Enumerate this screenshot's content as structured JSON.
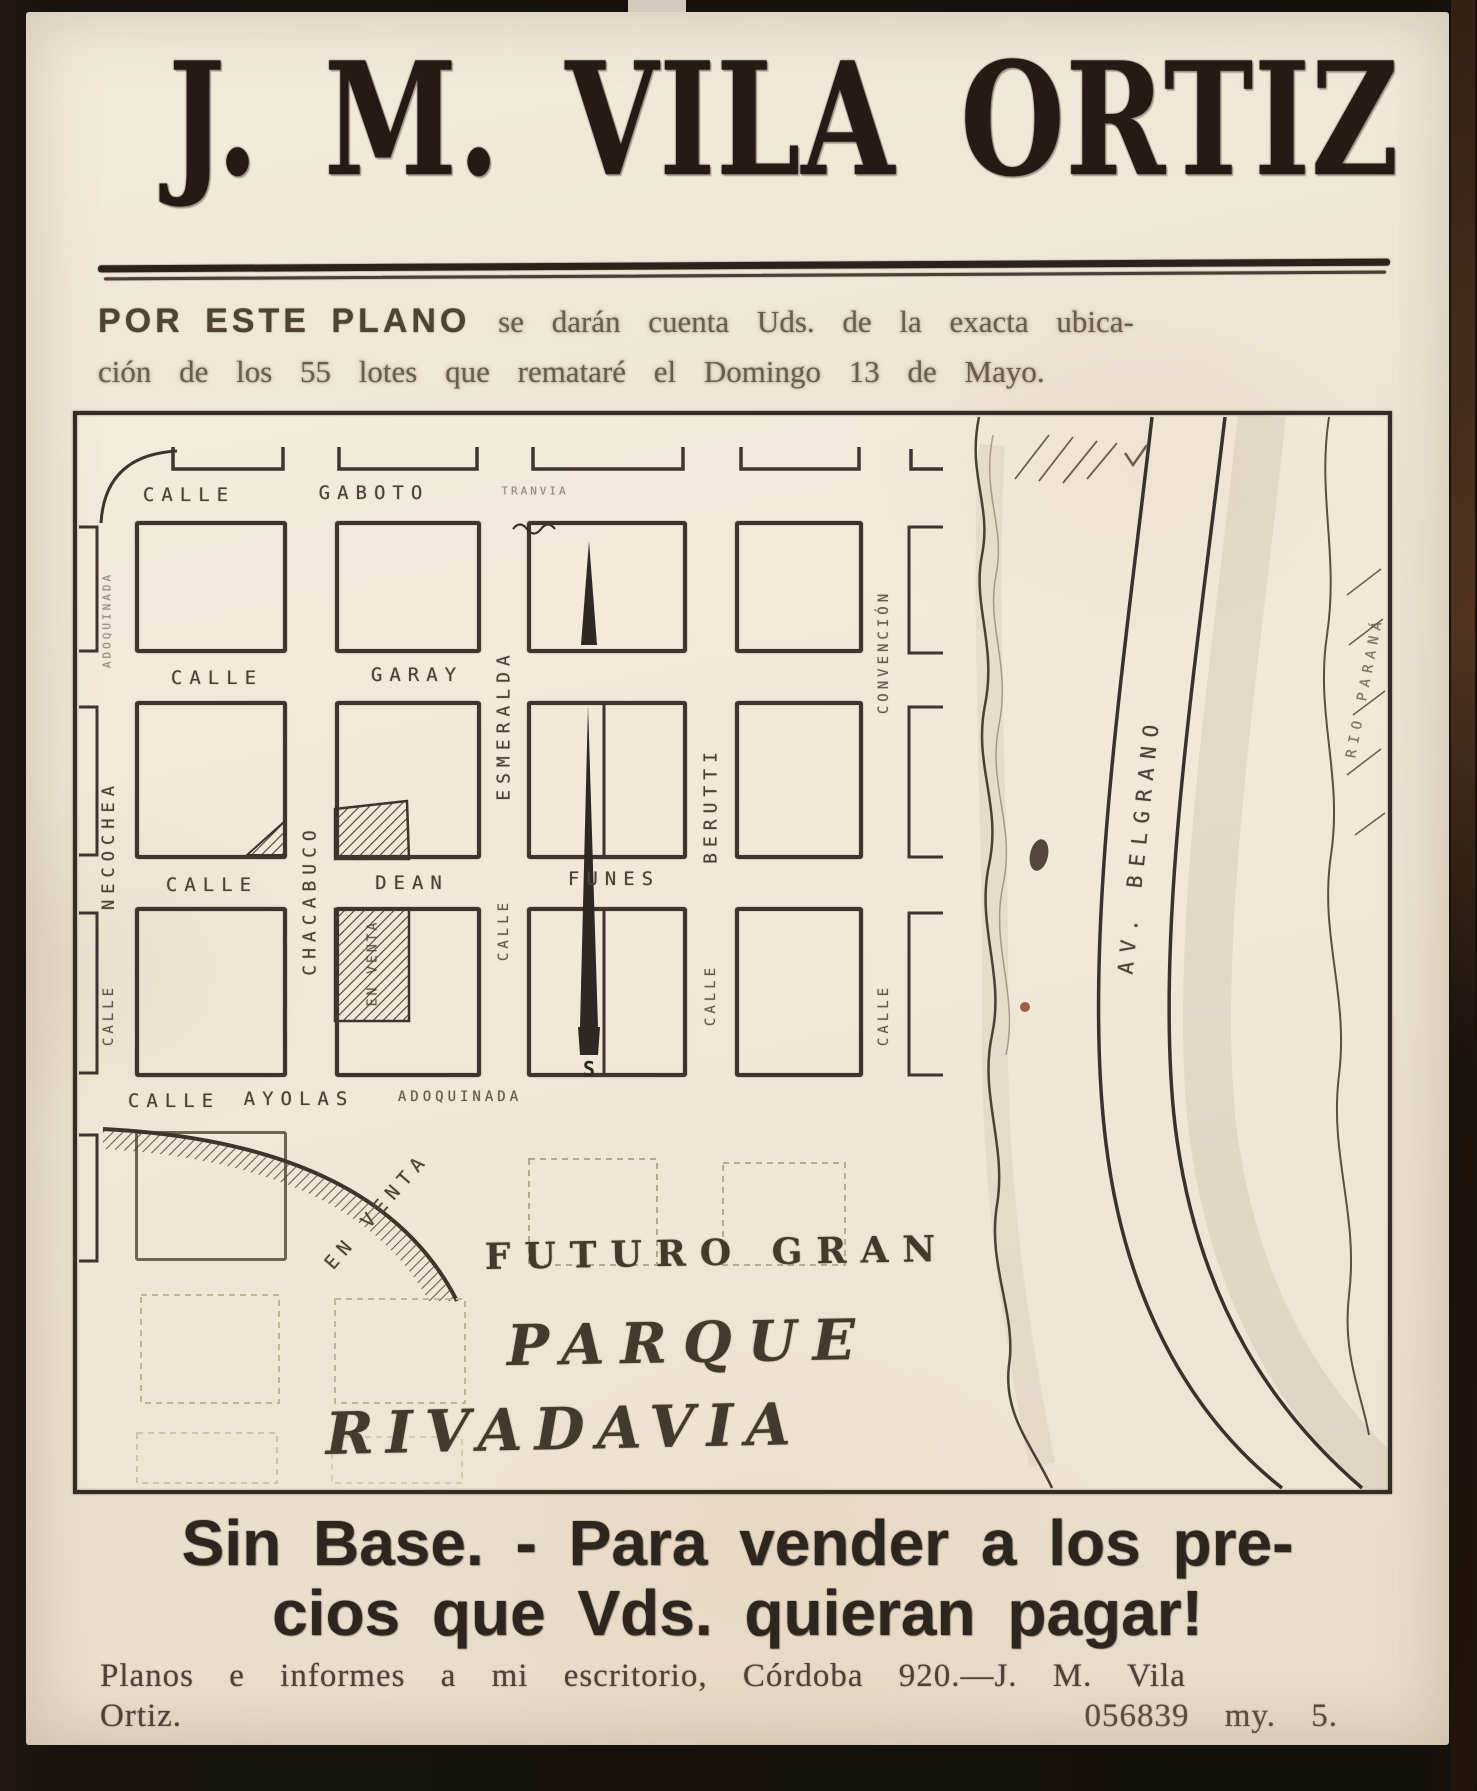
{
  "masthead": {
    "title": "J. M. VILA ORTIZ"
  },
  "intro": {
    "lead": "POR ESTE PLANO",
    "line1_rest": "se darán cuenta Uds. de la exacta ubica-",
    "line2": "ción de los 55 lotes que remataré el Domingo 13 de Mayo."
  },
  "map": {
    "labels": {
      "calle_gaboto": "CALLE",
      "gaboto": "GABOTO",
      "tranvia": "TRANVIA",
      "calle_garay": "CALLE",
      "garay": "GARAY",
      "calle_dean": "CALLE",
      "dean": "DEAN",
      "funes": "FUNES",
      "calle_ayolas": "CALLE",
      "ayolas": "AYOLAS",
      "adoquinada": "ADOQUINADA",
      "left_note": "ADOQUINADA",
      "necochea": "NECOCHEA",
      "calle_left": "CALLE",
      "chacabuco": "CHACABUCO",
      "esmeralda": "ESMERALDA",
      "calle_esmeralda": "CALLE",
      "berutti": "BERUTTI",
      "calle_berutti": "CALLE",
      "convencion": "CONVENCIÓN",
      "calle_convencion": "CALLE",
      "av_belgrano": "AV. BELGRANO",
      "rio_parana": "RIO PARANÁ",
      "en_venta_block": "EN VENTA",
      "en_venta_park": "EN VENTA",
      "south_marker": "S"
    },
    "park": {
      "line1": "FUTURO GRAN",
      "line2": "PARQUE",
      "line3": "RIVADAVIA"
    }
  },
  "footer": {
    "headline_line1": "Sin Base. - Para vender a los pre-",
    "headline_line2": "cios que Vds. quieran pagar!",
    "contact_line1": "Planos e informes a mi escritorio, Córdoba 920.—J. M. Vila",
    "contact_line2": "Ortiz.",
    "serial": "056839 my. 5."
  },
  "colors": {
    "paper": "#ece4d4",
    "ink": "#241b15",
    "map_ink": "#3e352c",
    "frame": "#17120d"
  }
}
